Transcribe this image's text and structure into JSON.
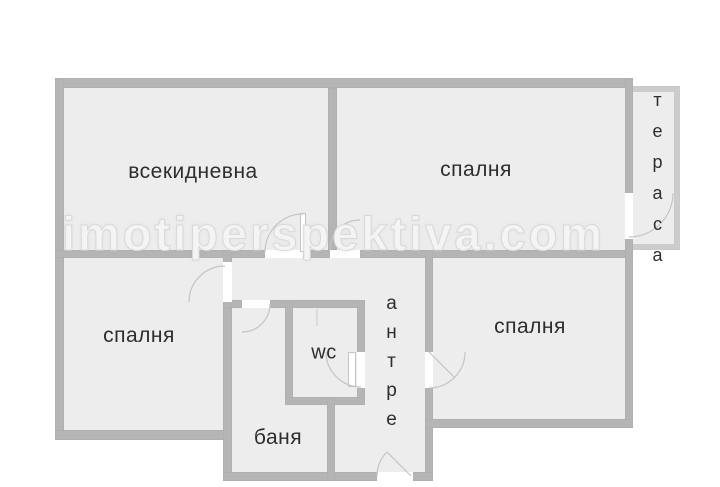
{
  "page": {
    "type": "apartment-floor-plan"
  },
  "watermark": {
    "text": "imotiperspektiva.com"
  },
  "rooms": {
    "living_room": {
      "label": "всекидневна"
    },
    "bedroom_top_right": {
      "label": "спалня"
    },
    "bedroom_bottom_left": {
      "label": "спалня"
    },
    "bedroom_bottom_right": {
      "label": "спалня"
    },
    "terrace": {
      "label": "тераса"
    },
    "toilet": {
      "label": "wc"
    },
    "bathroom": {
      "label": "баня"
    },
    "hallway": {
      "label": "антре"
    }
  },
  "colors": {
    "room_fill": "#ededed",
    "wall": "#b5b5b5",
    "wall_edge": "#9e9e9e",
    "wall_light": "#cccccc",
    "wall_light_edge": "#bdbdbd",
    "label": "#2d2d2d",
    "arc": "#c4c4c4",
    "watermark": "#f4f4f4",
    "watermark_edge": "#d9d9d9"
  }
}
